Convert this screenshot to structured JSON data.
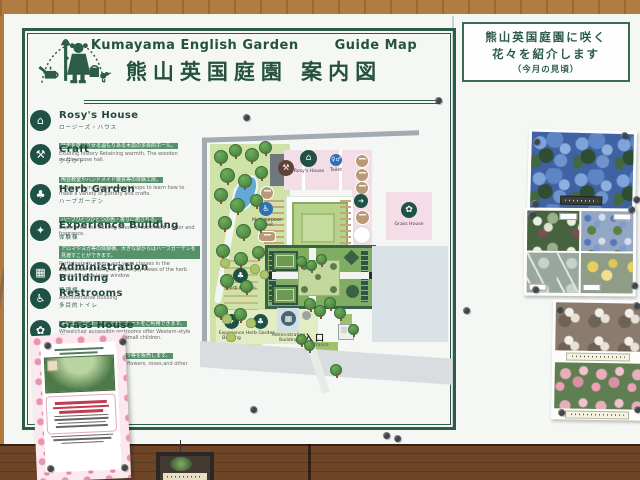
{
  "header": {
    "title_en": "Kumayama English Garden",
    "title_guide": "Guide Map",
    "title_jp": "熊山英国庭園 案内図"
  },
  "legend": {
    "items": [
      {
        "name": "Rosy's House",
        "jp": "ロージーズ・ハウス",
        "desc_jp": "歴史を感じさせる温もりある木造の多目的ホール。",
        "desc_en": "Exuding history Retaining warmth. The wooden multipurpose hall.",
        "icon": "⌂"
      },
      {
        "name": "Craft",
        "jp": "クラフト",
        "desc_jp": "陶芸教室やハンドメイド雑貨等の体験工房。",
        "desc_en": "Participate in hands-on workshops to learn how to make a variety of pottery and crafts.",
        "icon": "⚒"
      },
      {
        "name": "Herb Garden",
        "jp": "ハーブガーデン",
        "desc_jp": "ハーブひとつひとつの色・香りに癒される。",
        "desc_en": "Experience the healing effect of each herb's color and fragrance.",
        "icon": "♣"
      },
      {
        "name": "Experience Building",
        "jp": "体験棟",
        "desc_jp": "アロマやヨガ等の体験棟。大きな窓からはハーブガーデンを見渡すことができます。",
        "desc_en": "Participate in aroma and yoga classes in the Experience Building as you enjoy views of the herb garden from a large window.",
        "icon": "✦"
      },
      {
        "name": "Administration Building",
        "jp": "管理棟",
        "desc_jp": "",
        "desc_en": "Administrative Building",
        "icon": "▦"
      },
      {
        "name": "Restrooms",
        "jp": "多目的トイレ",
        "desc_jp": "車いす、洋式トイレ、ベビーシートをご利用できます。",
        "desc_en": "Wheelchair accessible restrooms offer Western-style toilets and potty seats for small children.",
        "icon": "♿"
      },
      {
        "name": "Grass House",
        "jp": "グラスハウス",
        "desc_jp": "イベント時に花苗、花木、バラ等を販売します。",
        "desc_en": "Purchase flower seedlings, flowers, roses,and other items during events.",
        "icon": "✿"
      }
    ]
  },
  "map": {
    "rosys_house": "Rosy's House",
    "toilet": "Toilet",
    "multipurpose_toilet": "Multipurpose Toilet",
    "herb_garden": "Herb Garden",
    "experience_building": "Experience Building",
    "administration_building": "Administration Building",
    "grass_house": "Grass House",
    "entrance_jp": "入口",
    "entrance_en": "Entrance"
  },
  "right_panel": {
    "notice_line1": "熊山英国庭園に咲く",
    "notice_line2": "花々を紹介します",
    "notice_line3": "（今月の見頃）",
    "photos": [
      "blue-hydrangea-photo",
      "seasonal-flower-grid-photo",
      "white-blossom-photo",
      "pink-rose-photo"
    ]
  },
  "colors": {
    "frame_green": "#2d5c49",
    "board_white": "#f5f7f4",
    "wood_top": "#b17c41",
    "wood_bottom": "#6e4627",
    "map_lawn": "#cfe3a8",
    "building_pink": "#f3dde7",
    "toilet_blue": "#2f6fb3"
  }
}
